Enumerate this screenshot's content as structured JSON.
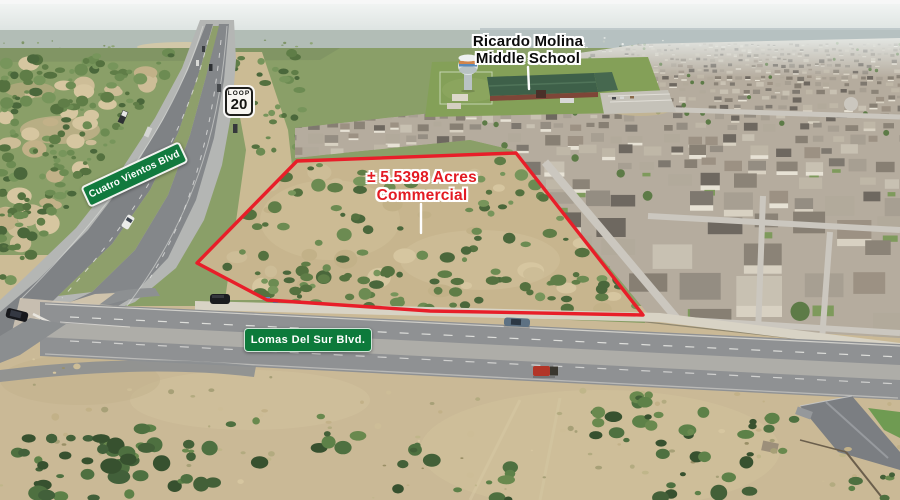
{
  "annotations": {
    "school": {
      "line1": "Ricardo Molina",
      "line2": "Middle School"
    },
    "parcel": {
      "line1": "± 5.5398 Acres",
      "line2": "Commercial"
    },
    "street_signs": {
      "cuatro_vientos": "Cuatro Vientos Blvd",
      "lomas_del_sur": "Lomas Del Sur Blvd."
    },
    "route_shield": {
      "banner": "LOOP",
      "number": "20"
    }
  },
  "colors": {
    "parcel_outline_red": "#e81e29",
    "parcel_label_red": "#e31b23",
    "school_label_black": "#0b0b0b",
    "street_sign_green": "#117a3e",
    "shield_white": "#f7f5f1",
    "leader_line_white": "#fdfdfd"
  }
}
